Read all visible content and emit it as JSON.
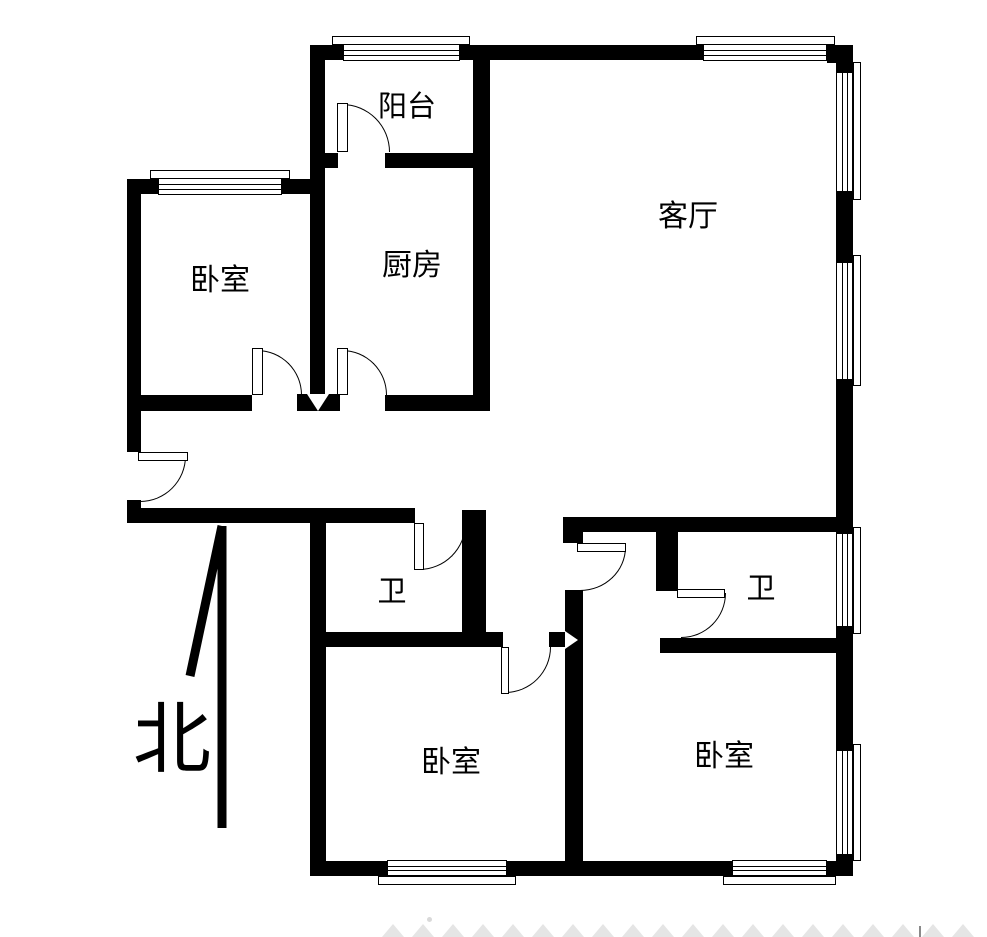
{
  "compass": {
    "label": "北"
  },
  "rooms": [
    {
      "id": "balcony",
      "label": "阳台"
    },
    {
      "id": "kitchen",
      "label": "厨房"
    },
    {
      "id": "bedroom-nw",
      "label": "卧室"
    },
    {
      "id": "living-room",
      "label": "客厅"
    },
    {
      "id": "bathroom-left",
      "label": "卫"
    },
    {
      "id": "bathroom-right",
      "label": "卫"
    },
    {
      "id": "bedroom-south",
      "label": "卧室"
    },
    {
      "id": "bedroom-se",
      "label": "卧室"
    }
  ],
  "colors": {
    "wall": "#000000",
    "background": "#ffffff",
    "watermark": "#e5e5e5"
  }
}
